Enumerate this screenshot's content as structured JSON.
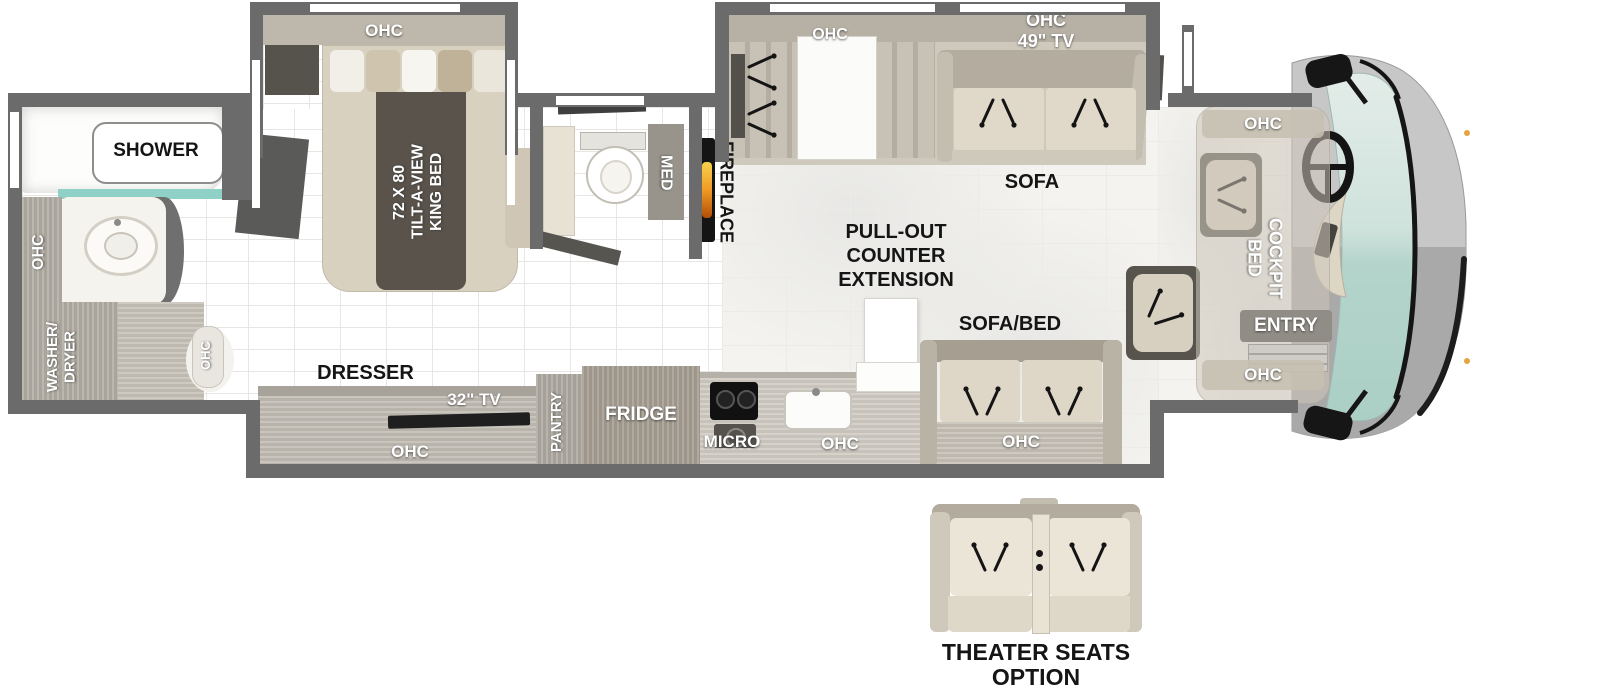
{
  "floorplan": {
    "rear_bath": {
      "shower": "SHOWER",
      "ohc": "OHC",
      "washer_dryer_1": "WASHER/",
      "washer_dryer_2": "DRYER",
      "wardrobe_ohc": "OHC"
    },
    "bedroom": {
      "ohc": "OHC",
      "bed_size": "72 X 80",
      "bed_type": "TILT-A-VIEW",
      "bed_name": "KING BED",
      "dresser": "DRESSER",
      "tv": "32\" TV",
      "dresser_ohc": "OHC"
    },
    "bathroom": {
      "med": "MED"
    },
    "kitchen": {
      "fireplace": "FIREPLACE",
      "pantry": "PANTRY",
      "fridge": "FRIDGE",
      "micro": "MICRO",
      "ohc": "OHC",
      "counter_1": "PULL-OUT",
      "counter_2": "COUNTER",
      "counter_3": "EXTENSION"
    },
    "living": {
      "hutch_ohc": "OHC",
      "tv_ohc_1": "OHC",
      "tv_ohc_2": "49\" TV",
      "sofa": "SOFA",
      "sofa_bed": "SOFA/BED",
      "sofa_bed_ohc": "OHC"
    },
    "cockpit": {
      "ohc_top": "OHC",
      "bed_1": "COCKPIT",
      "bed_2": "BED",
      "entry": "ENTRY",
      "ohc_bottom": "OHC"
    },
    "options": {
      "theater_1": "THEATER SEATS",
      "theater_2": "OPTION"
    },
    "colors": {
      "wall": "#6b6b6b",
      "wood": "#b5afa5",
      "fabric": "#ded7c7",
      "dark_accent": "#57544e",
      "windshield": "#bdd9d1",
      "shower_glass": "#8fd0c7",
      "flame": "#f0a43c"
    }
  }
}
